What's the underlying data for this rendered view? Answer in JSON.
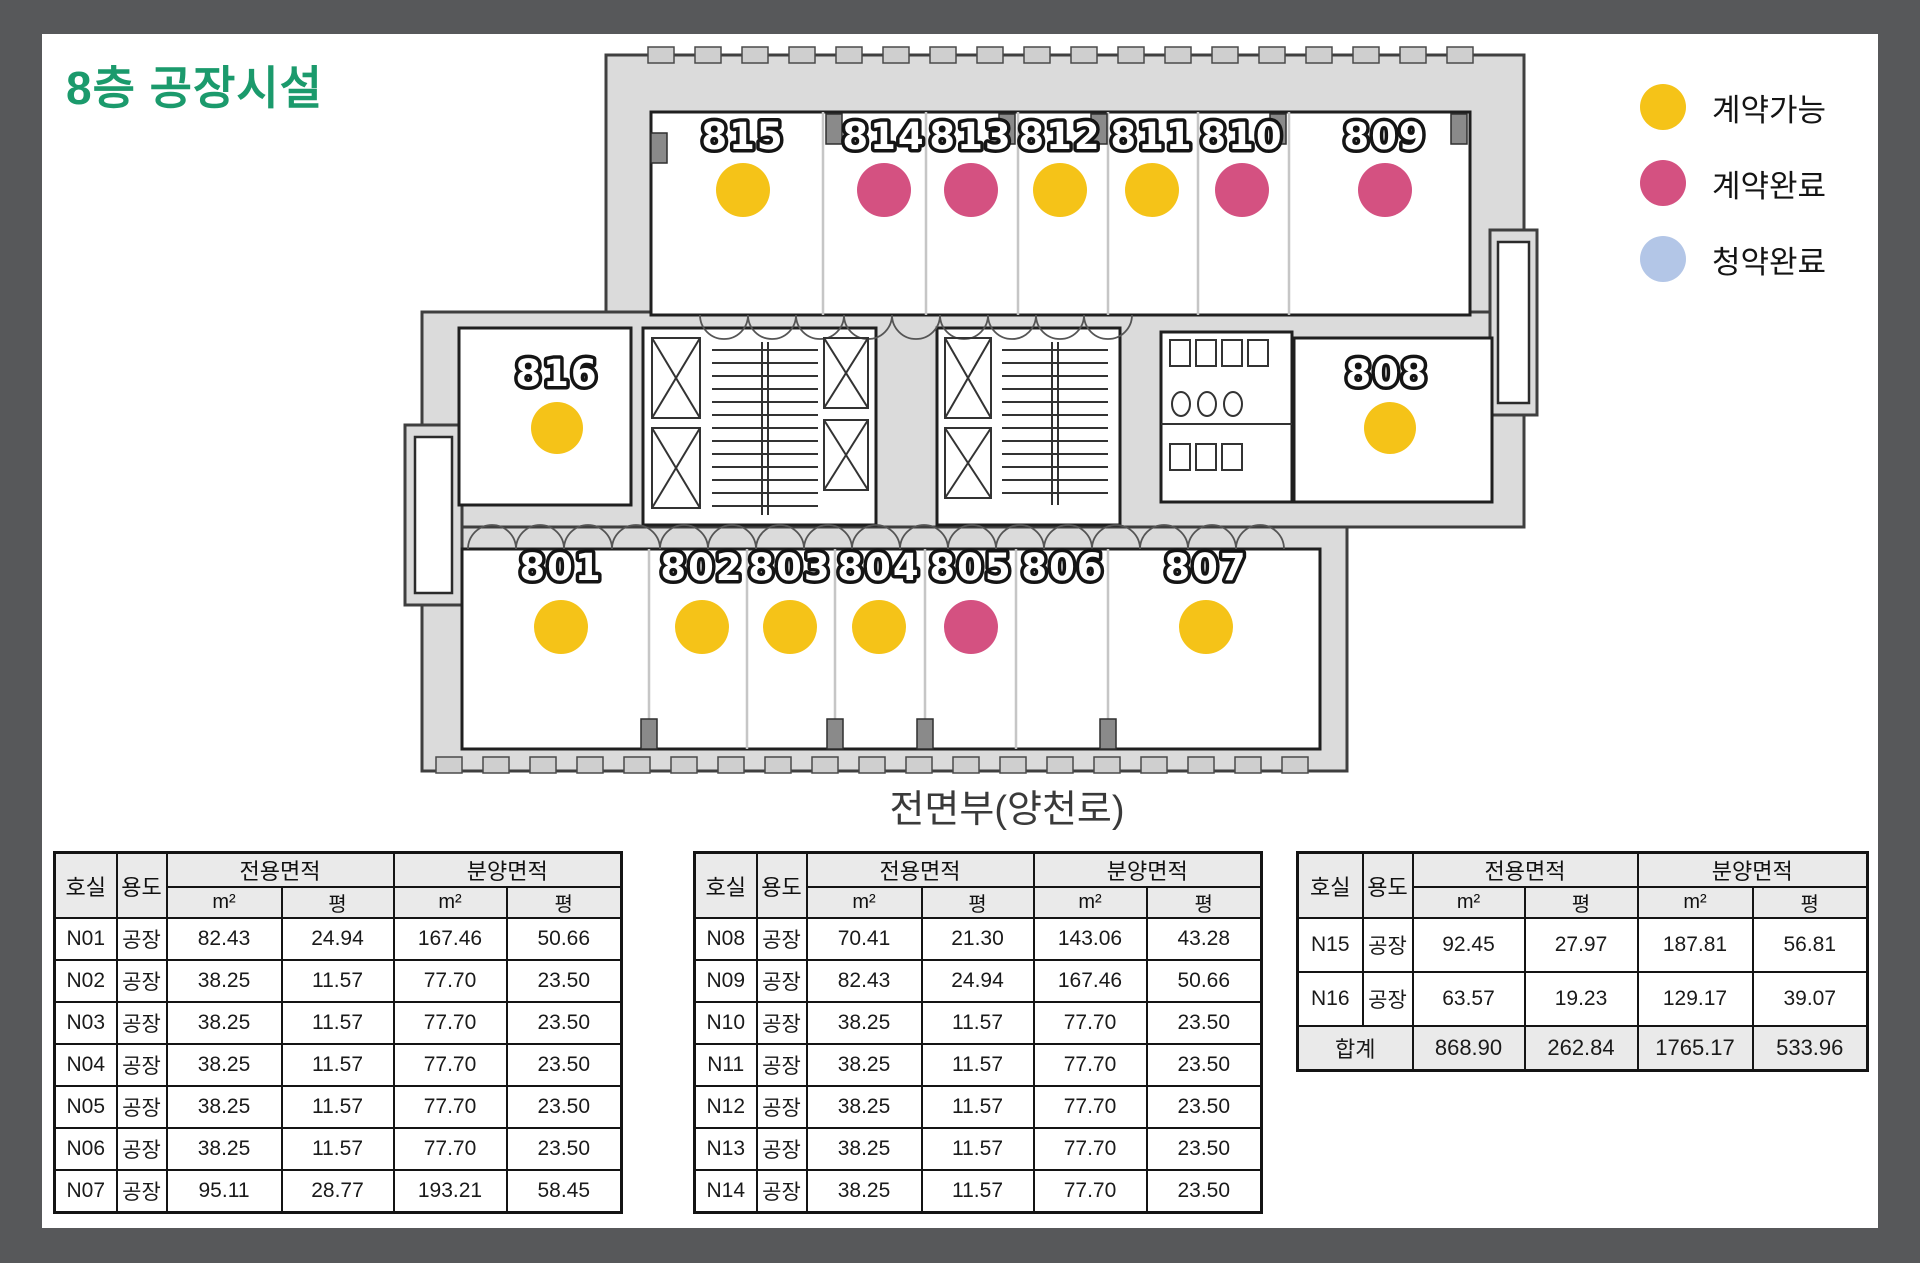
{
  "page": {
    "title": "8층 공장시설",
    "title_color": "#1B9A6C"
  },
  "legend": {
    "items": [
      {
        "label": "계약가능",
        "color": "#F5C318"
      },
      {
        "label": "계약완료",
        "color": "#D45181"
      },
      {
        "label": "청약완료",
        "color": "#B3C6E7"
      }
    ]
  },
  "floorplan": {
    "caption": "전면부(양천로)",
    "rooms": [
      {
        "number": "815",
        "status": "계약가능",
        "dot_color": "#F5C318"
      },
      {
        "number": "814",
        "status": "계약완료",
        "dot_color": "#D45181"
      },
      {
        "number": "813",
        "status": "계약완료",
        "dot_color": "#D45181"
      },
      {
        "number": "812",
        "status": "계약가능",
        "dot_color": "#F5C318"
      },
      {
        "number": "811",
        "status": "계약가능",
        "dot_color": "#F5C318"
      },
      {
        "number": "810",
        "status": "계약완료",
        "dot_color": "#D45181"
      },
      {
        "number": "809",
        "status": "계약완료",
        "dot_color": "#D45181"
      },
      {
        "number": "816",
        "status": "계약가능",
        "dot_color": "#F5C318"
      },
      {
        "number": "808",
        "status": "계약가능",
        "dot_color": "#F5C318"
      },
      {
        "number": "801",
        "status": "계약가능",
        "dot_color": "#F5C318"
      },
      {
        "number": "802",
        "status": "계약가능",
        "dot_color": "#F5C318"
      },
      {
        "number": "803",
        "status": "계약가능",
        "dot_color": "#F5C318"
      },
      {
        "number": "804",
        "status": "계약가능",
        "dot_color": "#F5C318"
      },
      {
        "number": "805",
        "status": "계약완료",
        "dot_color": "#D45181"
      },
      {
        "number": "806",
        "status": null,
        "dot_color": null
      },
      {
        "number": "807",
        "status": "계약가능",
        "dot_color": "#F5C318"
      }
    ]
  },
  "table_headers": {
    "room": "호실",
    "use": "용도",
    "exclusive": "전용면적",
    "supply": "분양면적",
    "sqm": "m²",
    "pyeong": "평",
    "total": "합계"
  },
  "tables": [
    {
      "rows": [
        [
          "N01",
          "공장",
          "82.43",
          "24.94",
          "167.46",
          "50.66"
        ],
        [
          "N02",
          "공장",
          "38.25",
          "11.57",
          "77.70",
          "23.50"
        ],
        [
          "N03",
          "공장",
          "38.25",
          "11.57",
          "77.70",
          "23.50"
        ],
        [
          "N04",
          "공장",
          "38.25",
          "11.57",
          "77.70",
          "23.50"
        ],
        [
          "N05",
          "공장",
          "38.25",
          "11.57",
          "77.70",
          "23.50"
        ],
        [
          "N06",
          "공장",
          "38.25",
          "11.57",
          "77.70",
          "23.50"
        ],
        [
          "N07",
          "공장",
          "95.11",
          "28.77",
          "193.21",
          "58.45"
        ]
      ],
      "total": null
    },
    {
      "rows": [
        [
          "N08",
          "공장",
          "70.41",
          "21.30",
          "143.06",
          "43.28"
        ],
        [
          "N09",
          "공장",
          "82.43",
          "24.94",
          "167.46",
          "50.66"
        ],
        [
          "N10",
          "공장",
          "38.25",
          "11.57",
          "77.70",
          "23.50"
        ],
        [
          "N11",
          "공장",
          "38.25",
          "11.57",
          "77.70",
          "23.50"
        ],
        [
          "N12",
          "공장",
          "38.25",
          "11.57",
          "77.70",
          "23.50"
        ],
        [
          "N13",
          "공장",
          "38.25",
          "11.57",
          "77.70",
          "23.50"
        ],
        [
          "N14",
          "공장",
          "38.25",
          "11.57",
          "77.70",
          "23.50"
        ]
      ],
      "total": null
    },
    {
      "rows": [
        [
          "N15",
          "공장",
          "92.45",
          "27.97",
          "187.81",
          "56.81"
        ],
        [
          "N16",
          "공장",
          "63.57",
          "19.23",
          "129.17",
          "39.07"
        ]
      ],
      "total": [
        "합계",
        "868.90",
        "262.84",
        "1765.17",
        "533.96"
      ]
    }
  ]
}
